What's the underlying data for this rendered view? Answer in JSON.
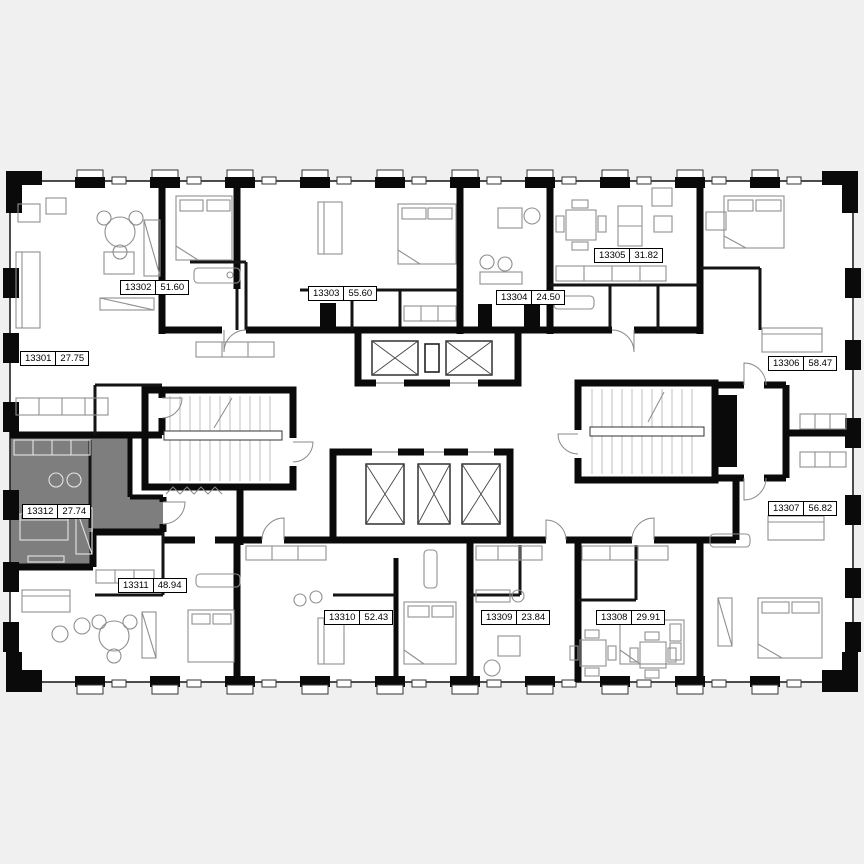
{
  "canvas": {
    "background_color": "#f0f0f0",
    "plan_fill_color": "#ffffff",
    "wall_color": "#0a0a0a",
    "highlight_color": "#7e7e7e"
  },
  "selected_unit_id": "13312",
  "units": [
    {
      "id": "13301",
      "area": "27.75",
      "highlighted": false,
      "label": {
        "x": 20,
        "y": 351
      }
    },
    {
      "id": "13302",
      "area": "51.60",
      "highlighted": false,
      "label": {
        "x": 120,
        "y": 280
      }
    },
    {
      "id": "13303",
      "area": "55.60",
      "highlighted": false,
      "label": {
        "x": 308,
        "y": 286
      }
    },
    {
      "id": "13304",
      "area": "24.50",
      "highlighted": false,
      "label": {
        "x": 496,
        "y": 290
      }
    },
    {
      "id": "13305",
      "area": "31.82",
      "highlighted": false,
      "label": {
        "x": 594,
        "y": 248
      }
    },
    {
      "id": "13306",
      "area": "58.47",
      "highlighted": false,
      "label": {
        "x": 768,
        "y": 356
      }
    },
    {
      "id": "13307",
      "area": "56.82",
      "highlighted": false,
      "label": {
        "x": 768,
        "y": 501
      }
    },
    {
      "id": "13308",
      "area": "29.91",
      "highlighted": false,
      "label": {
        "x": 596,
        "y": 610
      }
    },
    {
      "id": "13309",
      "area": "23.84",
      "highlighted": false,
      "label": {
        "x": 481,
        "y": 610
      }
    },
    {
      "id": "13310",
      "area": "52.43",
      "highlighted": false,
      "label": {
        "x": 324,
        "y": 610
      }
    },
    {
      "id": "13311",
      "area": "48.94",
      "highlighted": false,
      "label": {
        "x": 118,
        "y": 578
      }
    },
    {
      "id": "13312",
      "area": "27.74",
      "highlighted": true,
      "label": {
        "x": 22,
        "y": 504
      }
    }
  ]
}
